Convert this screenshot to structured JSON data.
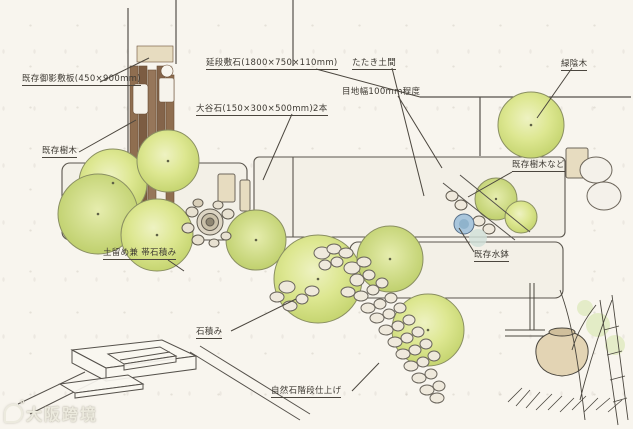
{
  "labels": {
    "granite_slab": "既存御影敷板(450×900mm)",
    "existing_tree_left": "既存樹木",
    "paving_stone": "延段敷石(1800×750×110mm)",
    "oya_stone": "大谷石(150×300×500mm)2本",
    "tataki_doma": "たたき土間",
    "joint_width": "目地幅100mm程度",
    "shade_tree": "緑陰木",
    "existing_tree_right": "既存樹木など",
    "existing_water_basin": "既存水鉢",
    "retaining_band": "土留め兼 帯石積み",
    "stone_masonry": "石積み",
    "natural_stone_steps": "自然石階段仕上げ"
  },
  "watermark": {
    "text": "大阪跨境"
  },
  "colors": {
    "paper": "#f8f5ee",
    "pencil_line": "#55514b",
    "foliage": "#d3e187",
    "foliage_light": "#eef2c0",
    "wood_plank": "#8a6749",
    "stone_tan": "#e7dcc0",
    "water_blue": "#a9c6dc",
    "pebble": "#efe9dc"
  }
}
